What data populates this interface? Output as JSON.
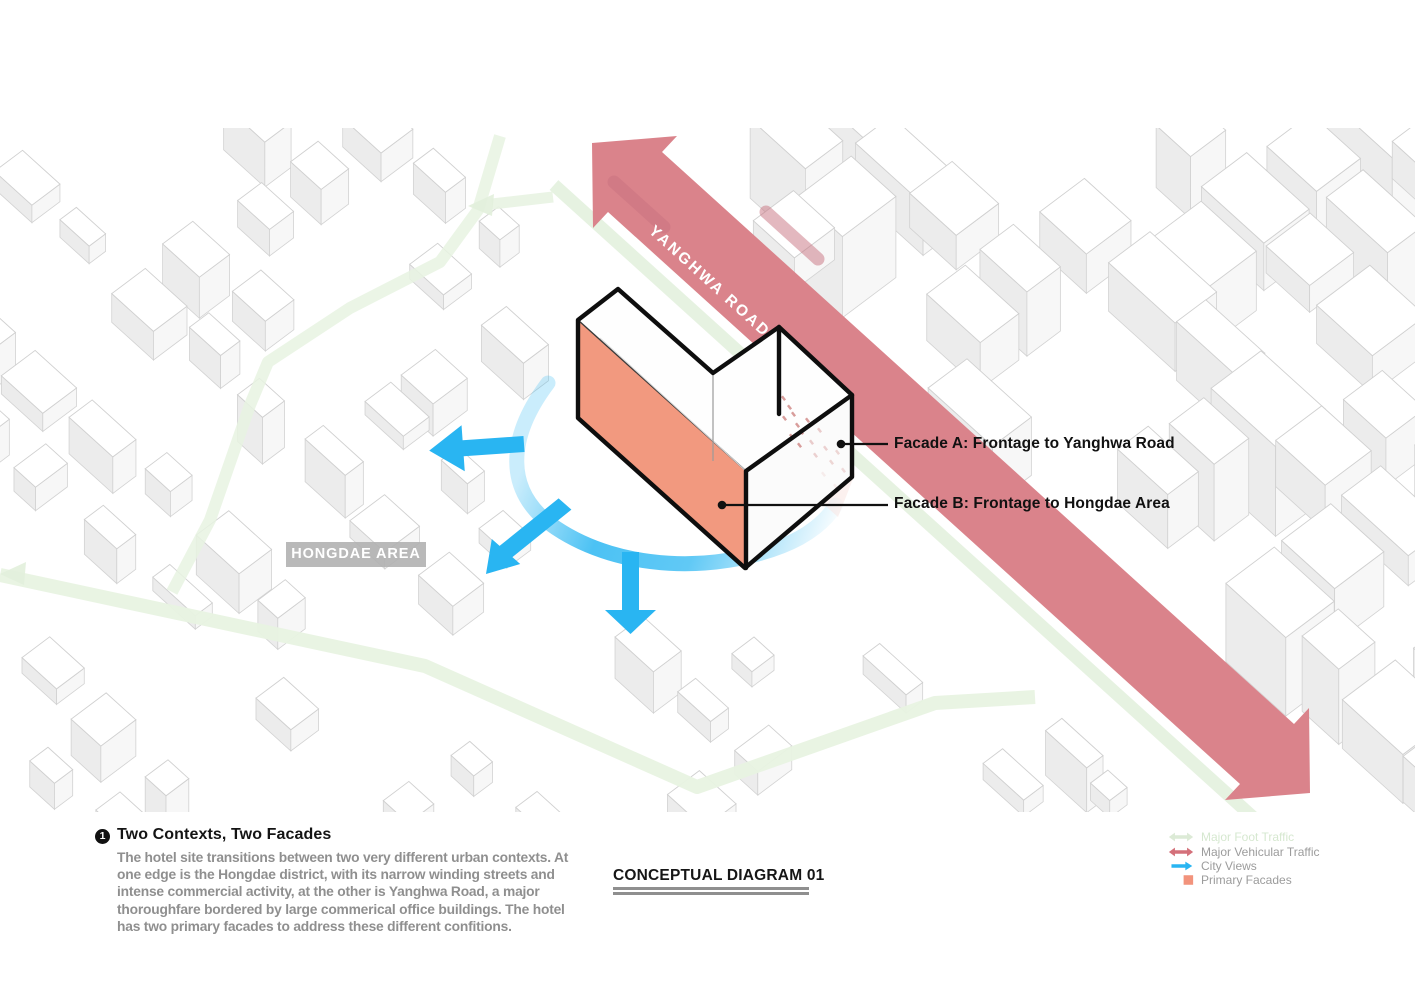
{
  "map": {
    "road_label": "YANGHWA ROAD",
    "area_label": "HONGDAE AREA",
    "facade_a_label": "Facade A: Frontage to Yanghwa Road",
    "facade_b_label": "Facade B: Frontage to Hongdae Area"
  },
  "notes": {
    "number": "1",
    "title": "Two Contexts, Two Facades",
    "body": "The hotel site transitions between two very different urban contexts. At one edge is the Hongdae district, with its narrow winding streets and intense commercial activity, at the other is Yanghwa Road, a major thoroughfare bordered by large commerical office buildings. The hotel has two primary facades to address these different confitions."
  },
  "caption": {
    "title": "CONCEPTUAL DIAGRAM 01"
  },
  "legend": {
    "items": [
      {
        "label": "Major Foot Traffic",
        "color": "#dcead6"
      },
      {
        "label": "Major Vehicular Traffic",
        "color": "#d4707a"
      },
      {
        "label": "City Views",
        "color": "#29b5f2"
      },
      {
        "label": "Primary Facades",
        "color": "#f2937c"
      }
    ]
  },
  "colors": {
    "road": "#da838b",
    "foot_path": "#e7f2e1",
    "city_view": "#29b5f2",
    "facade_solid": "#f2997f",
    "facade_translucent": "#f9e3df"
  }
}
